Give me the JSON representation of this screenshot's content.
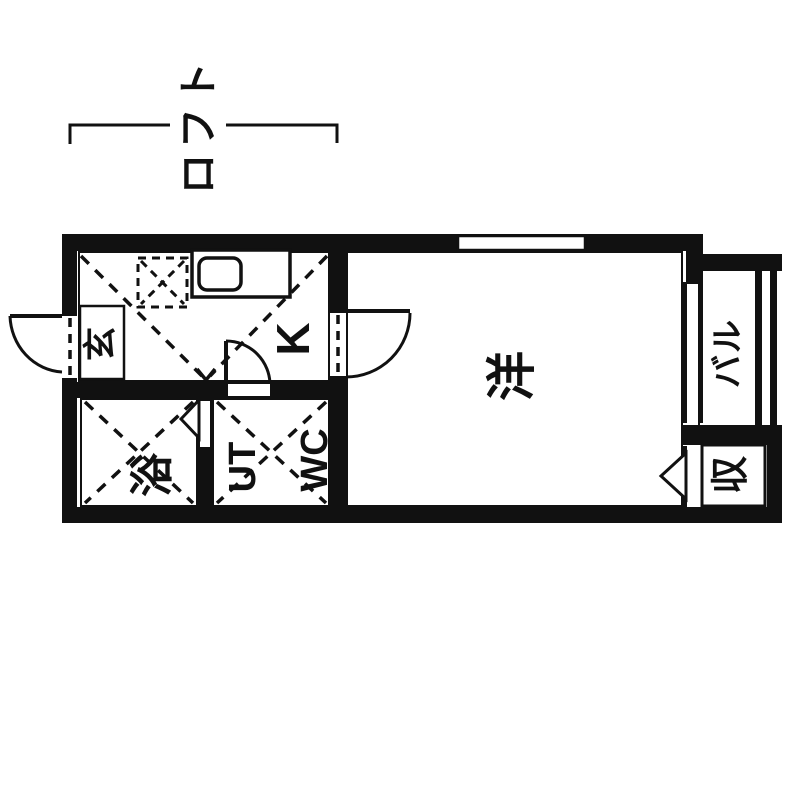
{
  "diagram": {
    "type": "japanese-apartment-floor-plan",
    "colors": {
      "wall": "#111111",
      "background": "#ffffff"
    },
    "loft": {
      "label": "ロフト"
    },
    "rooms": {
      "entrance": "玄",
      "kitchen": "K",
      "bath": "浴",
      "utility": "UT",
      "toilet": "WC",
      "main_room": "洋",
      "balcony": "バル",
      "storage": "収"
    }
  }
}
